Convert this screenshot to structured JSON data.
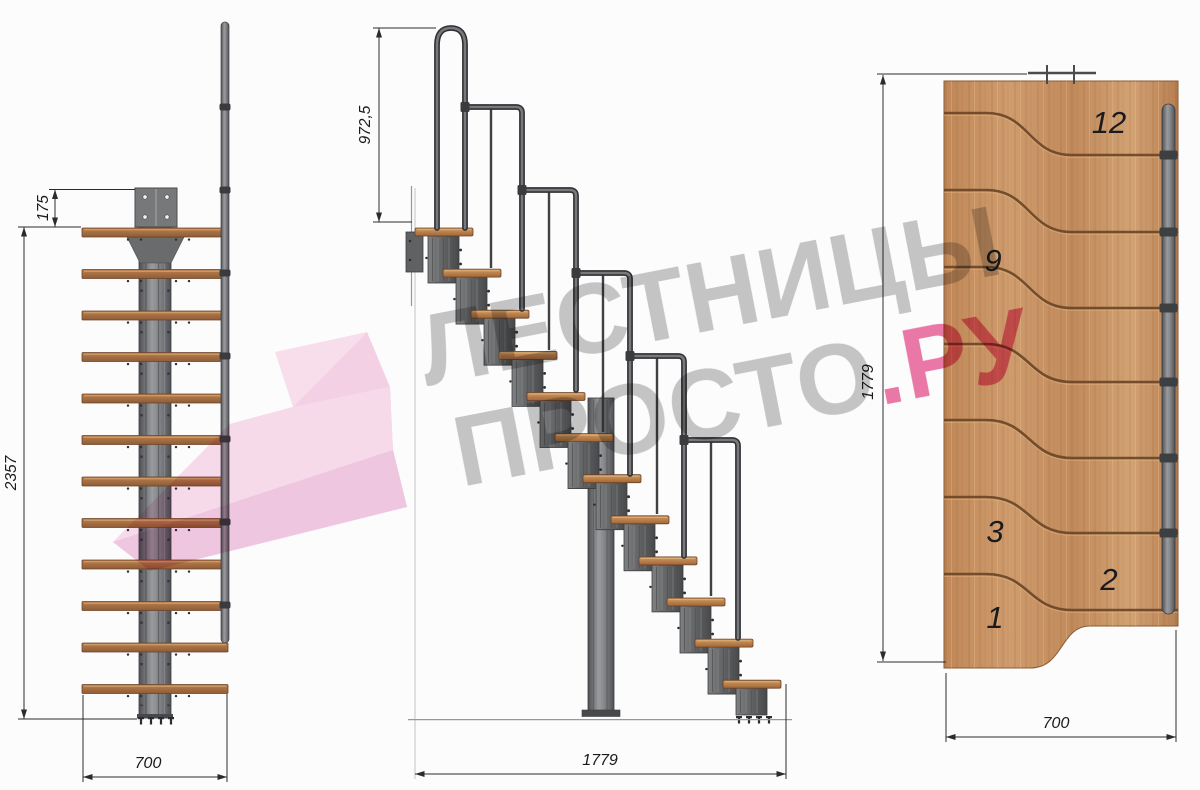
{
  "watermark": {
    "line1": "ЛЕСТНИЦЫ",
    "line2": "ПРОСТО",
    "line2_accent": ".РУ",
    "text_color": "#8f8f8f",
    "accent_color": "#e7538f"
  },
  "front_view": {
    "steps_count": 12,
    "dims": {
      "plate_offset": "175",
      "total_height": "2357",
      "width": "700"
    }
  },
  "side_view": {
    "steps_count": 12,
    "dims": {
      "handrail_height": "972,5",
      "length": "1779"
    }
  },
  "plan_view": {
    "step_labels": [
      "12",
      "9",
      "3",
      "2",
      "1"
    ],
    "dims": {
      "length": "1779",
      "width": "700"
    }
  },
  "palette": {
    "background": "#fcfcfd",
    "wood_plan": "#c68f61",
    "tread_wood": "#b07845",
    "metal": "#6f7073",
    "metal_dark": "#3c3d3f",
    "dimension_lines": "#2b2b2d",
    "ribbon_pink": "#f2bcda"
  }
}
